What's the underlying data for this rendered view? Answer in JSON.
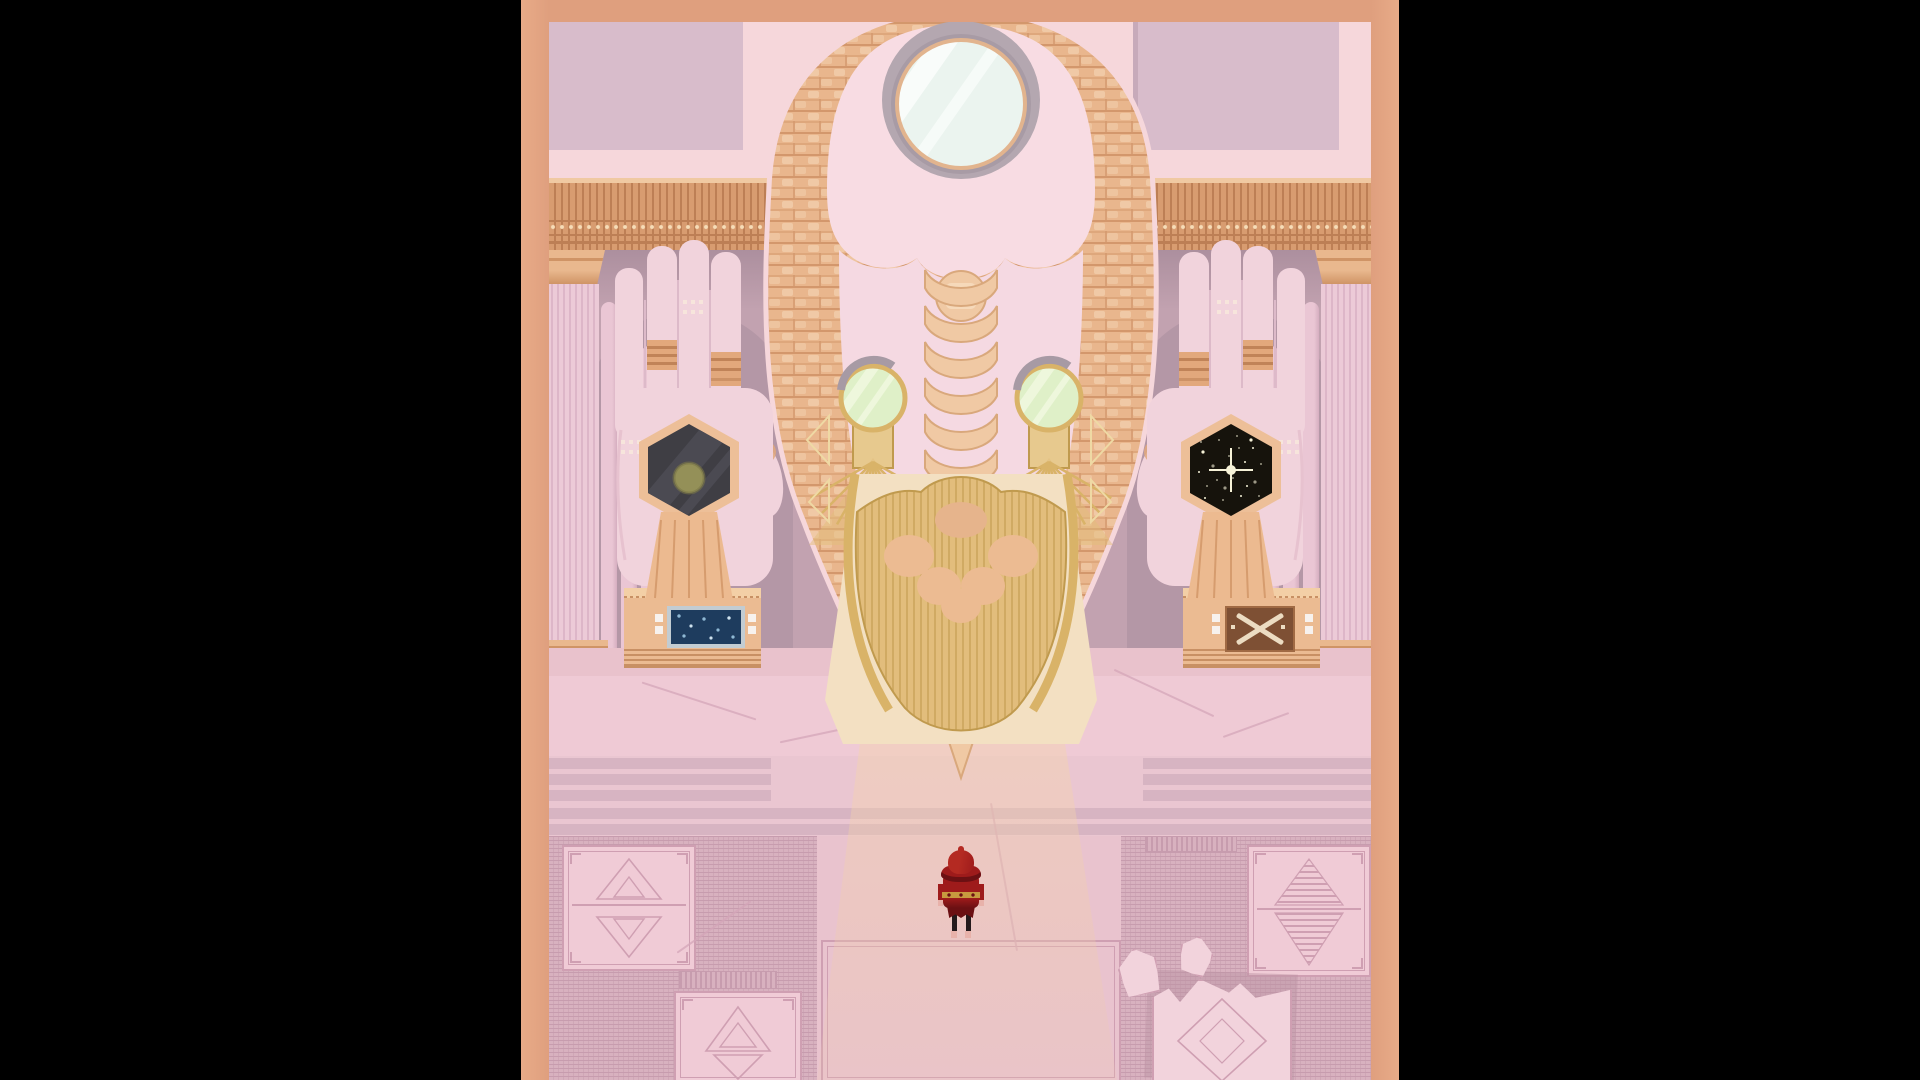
{
  "app": {
    "title": "Pixel-art temple scene — giant statue hall with red-hooded traveler"
  },
  "palette": {
    "black": "#000000",
    "salmon": "#df9f7e",
    "salmonLight": "#e8ab88",
    "wallFrame": "#f6d7db",
    "wallPanel": "#d8bccb",
    "wallPanelDark": "#b89cab",
    "friezeBase": "#d89c70",
    "friezeDark": "#bd7f55",
    "friezeLight": "#f0c9a2",
    "friezeDot": "#f6ddb8",
    "midwall": "#c2a2b0",
    "midwallShadow": "#ac8f9e",
    "arch": "#b295a4",
    "spire": "#eac6d4",
    "spireShade": "#d6aec0",
    "pillar": "#eccad7",
    "pillarStripe": "#ddb6c8",
    "pillarPeach": "#e9b88e",
    "pillarPeachDark": "#cf9466",
    "hand": "#f1d3dc",
    "handShadow": "#ddbac9",
    "handLine": "#e7c2cf",
    "ringGold": "#e2a87c",
    "ringDark": "#c08358",
    "tattooCream": "#f8e7dc",
    "hexRim": "#edbf98",
    "hexDarkA": "#3f3e44",
    "hexStreakA": "#4b4a52",
    "hexOlive": "#949058",
    "hexDarkB": "#16130c",
    "star": "#f6f2d8",
    "tassel": "#ecba90",
    "tasselLine": "#d69c6e",
    "skull": "#f8dce3",
    "skullShade": "#eec6d1",
    "facePink": "#f5d9e2",
    "ringGray": "#b4a7b0",
    "ringGrayDark": "#a89ba5",
    "mirror": "#ebf4ef",
    "mirrorStreak": "#f9fcfa",
    "mirrorRim": "#e2b48e",
    "hair": "#e9b68d",
    "hairLight": "#f6d9ba",
    "hairDark": "#d3976c",
    "braid": "#f0c9a4",
    "braidDark": "#d9a87c",
    "eyeGlass": "#dff0c8",
    "eyeStreak": "#eef7dc",
    "eyeGray": "#a79aa4",
    "gold": "#d9b368",
    "goldLight": "#efd9a4",
    "goldDark": "#c09a4e",
    "beard": "#e2bd7c",
    "glow": "#f3e0c2",
    "pedestal": "#ebbb92",
    "pedestalLight": "#f3cfa6",
    "pedestalDark": "#c89064",
    "screenFrame": "#c2ccd2",
    "screenNavy": "#1e3c5e",
    "screenGlyph": "#8fb8d4",
    "buttonWhite": "#f7f2ee",
    "crate": "#7e5034",
    "crateLight": "#a06a44",
    "crateCream": "#ecdcc2",
    "platform": "#efcad5",
    "floorStrip": "#e9c2cc",
    "crack": "#d4a6b8",
    "step": "#d7b4c2",
    "stepBg": "#eac6d1",
    "mazeBase": "#d8b1bf",
    "mazeLine": "#c79cae",
    "mazeLine2": "#cfa7b6",
    "walkway": "#e9c3ce",
    "panelPink": "#f0cbd6",
    "panelLine": "#cf9fb2",
    "slab": "#f2d3dc",
    "slabShadow": "#ba93a2",
    "cloakRed": "#9e1b1b",
    "cloakDark": "#6b1013",
    "cloakBright": "#b42a22",
    "belt": "#c79a3f",
    "leg": "#241a1c",
    "skin": "#e8b2aa"
  },
  "scene": {
    "letterbox_color": "#000000",
    "statue": {
      "name": "giant-braided-head",
      "eye_count": 2,
      "top_oculus": "round-mirror",
      "beard": "gold-fan-comb"
    },
    "left_hand": {
      "artifact": "dark-hexagon-with-olive-orb"
    },
    "right_hand": {
      "artifact": "void-hexagon-starfield",
      "stars": [
        [
          -28,
          -18
        ],
        [
          -12,
          -30
        ],
        [
          6,
          -34
        ],
        [
          22,
          -22
        ],
        [
          30,
          -6
        ],
        [
          24,
          12
        ],
        [
          10,
          26
        ],
        [
          -8,
          30
        ],
        [
          -24,
          16
        ],
        [
          -32,
          2
        ],
        [
          -18,
          -4
        ],
        [
          -2,
          -14
        ],
        [
          14,
          -8
        ],
        [
          2,
          8
        ],
        [
          -14,
          10
        ],
        [
          20,
          -30
        ],
        [
          -30,
          -28
        ],
        [
          28,
          26
        ],
        [
          -26,
          28
        ],
        [
          8,
          -22
        ],
        [
          -6,
          18
        ],
        [
          16,
          16
        ]
      ]
    },
    "pedestals": {
      "left": "blue-star-chart-screen",
      "right": "crossed-hatch-panel"
    },
    "braid_chevron_rows": [
      270,
      306,
      342,
      378,
      414,
      450,
      486,
      522,
      558
    ],
    "fan_ray_angles": [
      30,
      45,
      60,
      75,
      90,
      105,
      120,
      135,
      150
    ],
    "player": {
      "name": "red-hooded-figure",
      "pose": "facing-statue"
    }
  }
}
